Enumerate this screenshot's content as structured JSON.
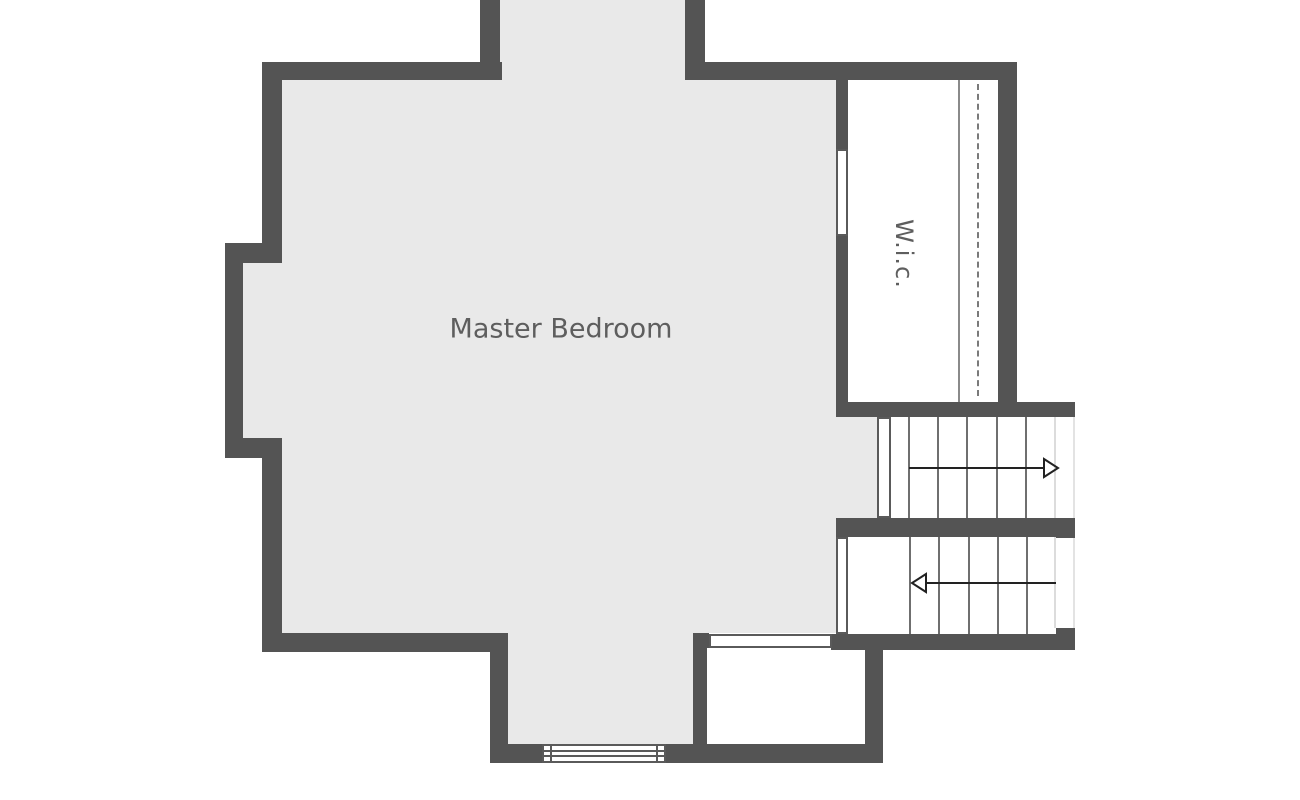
{
  "plan": {
    "rooms": [
      {
        "id": "master-bedroom",
        "label": "Master Bedroom"
      },
      {
        "id": "wic",
        "label": "W.i.c."
      }
    ],
    "stairs": {
      "upper_run": {
        "arrow_direction": "right",
        "tread_lines": 5
      },
      "lower_run": {
        "arrow_direction": "left",
        "tread_lines": 5
      }
    },
    "symbols": [
      "wic-door",
      "stair-door",
      "wall-opening",
      "window",
      "closet-rod-dashed-line",
      "closet-shelf-line"
    ],
    "colors": {
      "wall": "#545454",
      "floor": "#e9e9e9",
      "room": "#ffffff",
      "label": "#5e5e5e",
      "tread": "#6f6f6f",
      "arrow": "#222222",
      "symbol_outline": "#5a5a5a"
    }
  }
}
